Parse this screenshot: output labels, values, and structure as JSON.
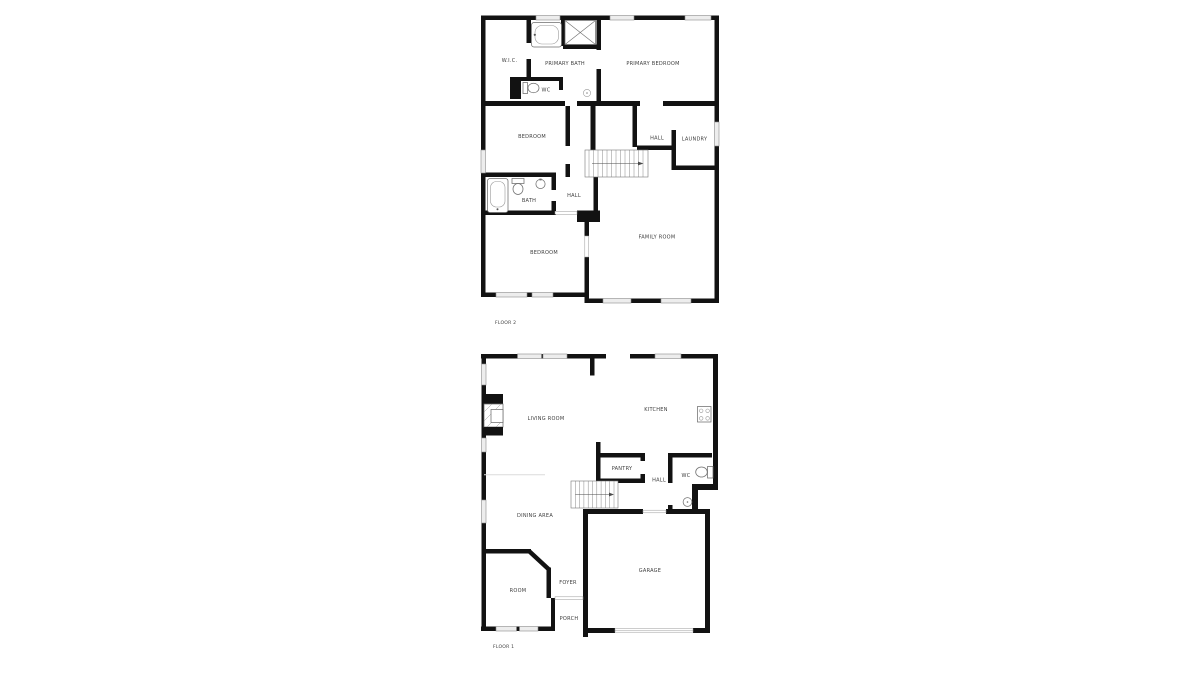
{
  "canvas": {
    "background": "#ffffff"
  },
  "floor2": {
    "title": "FLOOR 2",
    "rooms": {
      "wic": "W.I.C.",
      "primary_bath": "PRIMARY BATH",
      "primary_bedroom": "PRIMARY BEDROOM",
      "wc": "WC",
      "bedroom_upper": "BEDROOM",
      "hall_upper": "HALL",
      "laundry": "LAUNDRY",
      "bath": "BATH",
      "hall_lower": "HALL",
      "bedroom_lower": "BEDROOM",
      "family_room": "FAMILY ROOM"
    },
    "fixtures": [
      "bathtub-icon",
      "shower-icon",
      "toilet-icon",
      "ceiling-light-icon",
      "bathtub-icon",
      "toilet-icon",
      "sink-icon",
      "staircase"
    ]
  },
  "floor1": {
    "title": "FLOOR 1",
    "rooms": {
      "living_room": "LIVING ROOM",
      "kitchen": "KITCHEN",
      "pantry": "PANTRY",
      "hall": "HALL",
      "wc": "WC",
      "dining_area": "DINING AREA",
      "room": "ROOM",
      "foyer": "FOYER",
      "porch": "PORCH",
      "garage": "GARAGE"
    },
    "fixtures": [
      "fireplace-icon",
      "stove-icon",
      "toilet-icon",
      "sink-icon",
      "staircase"
    ]
  },
  "colors": {
    "wall": "#121212",
    "label": "#3d3d3d",
    "window_fill": "#ededed",
    "window_stroke": "#8a8a8a",
    "fixture_stroke": "#6e6e6e"
  }
}
